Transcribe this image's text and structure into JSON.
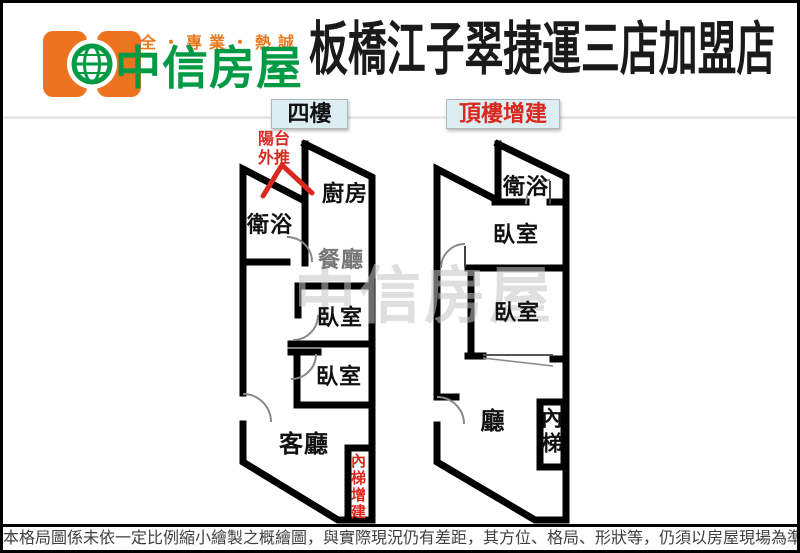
{
  "header": {
    "slogan": "安全・專業・熱誠",
    "brand": "中信房屋",
    "title": "板橋江子翠捷運三店加盟店"
  },
  "plans": {
    "left": {
      "label": "四樓",
      "balcony_note": "陽台外推",
      "rooms": {
        "kitchen": "廚房",
        "bath": "衛浴",
        "dining": "餐廳",
        "bedroom1": "臥室",
        "bedroom2": "臥室",
        "living": "客廳",
        "stairs_note": "內梯增建"
      }
    },
    "right": {
      "label": "頂樓增建",
      "rooms": {
        "bath": "衛浴",
        "bedroom1": "臥室",
        "bedroom2": "臥室",
        "hall": "廳",
        "stairs": "內梯"
      }
    }
  },
  "watermark": "中信房屋",
  "footer": {
    "disclaimer": "本格局圖係未依一定比例縮小繪製之概繪圖，與實際現況仍有差距，其方位、格局、形狀等，仍須以房屋現場為準"
  },
  "colors": {
    "brand_orange": "#E87A1E",
    "brand_green": "#009A44",
    "note_red": "#D9281E",
    "label_box_bg": "#DCEEF2",
    "wall_black": "#000000"
  }
}
